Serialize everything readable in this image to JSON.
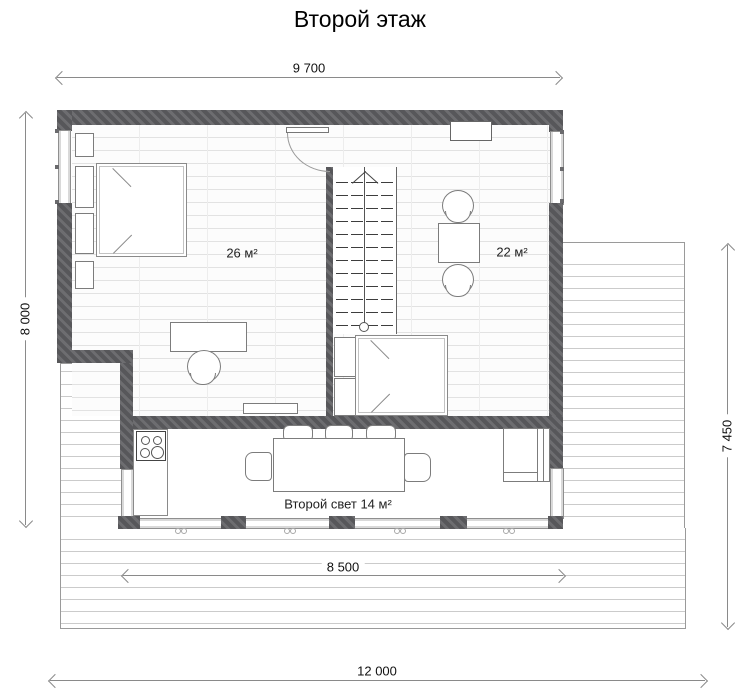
{
  "title": "Второй этаж",
  "dimensions": {
    "top": "9 700",
    "left": "8 000",
    "right": "7 450",
    "terrace": "8 500",
    "bottom": "12 000"
  },
  "rooms": {
    "bedroom": {
      "area": "26 м²"
    },
    "hall": {
      "area": "22 м²"
    },
    "void": {
      "area": "Второй свет 14 м²"
    }
  },
  "colors": {
    "wall": "#58585b",
    "window": "#d9d9d9",
    "dimension_line": "#8a8a8a",
    "floor_line": "#e2e2e2",
    "deck_line": "#cbcbcb"
  }
}
